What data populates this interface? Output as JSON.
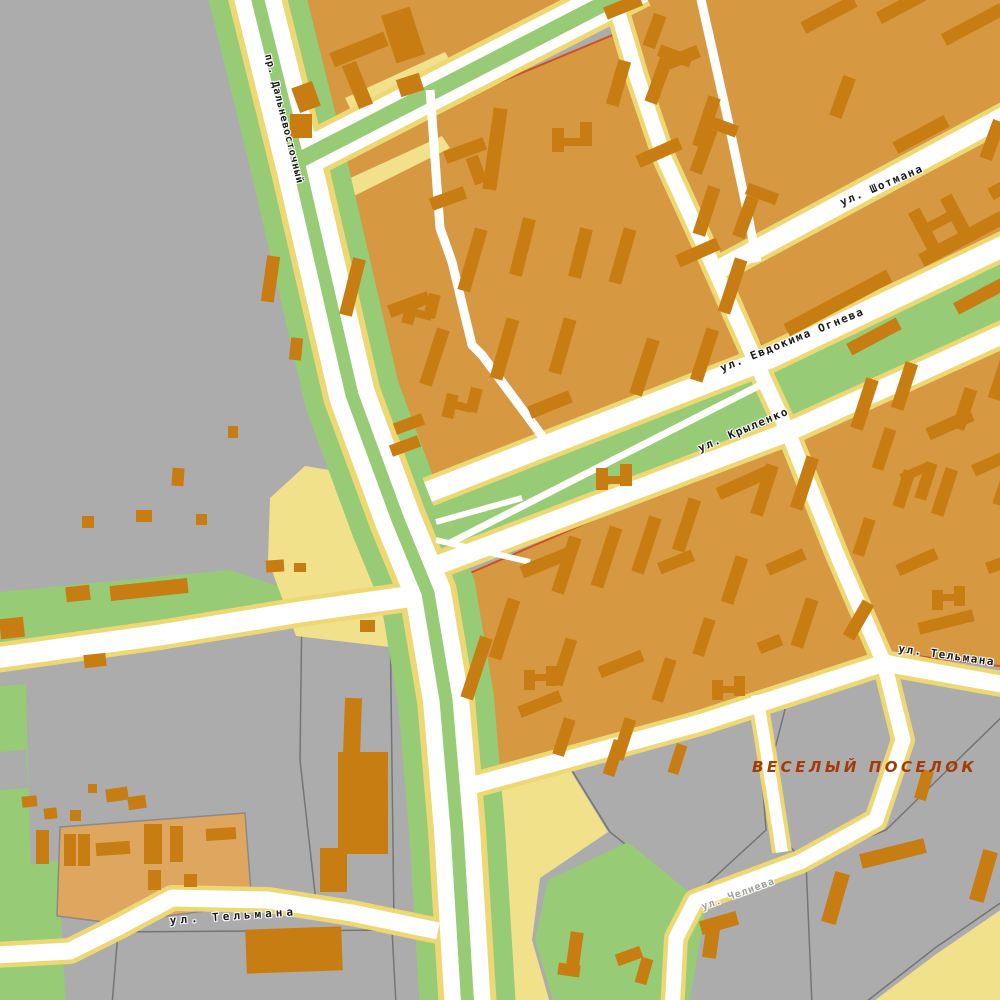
{
  "map": {
    "labels": {
      "prospekt_dalnevostochny": "пр. Дальневосточный",
      "shotmana": "ул. Шотмана",
      "evdokima_ogneva": "ул. Евдокима Огнева",
      "krylenko": "ул. Крыленко",
      "telmana_east": "ул. Тельмана",
      "telmana_west": "ул. Тельмана",
      "chelieva": "ул. Челиева",
      "district": "ВЕСЕЛЫЙ ПОСЕЛОК"
    },
    "palette": {
      "background_gray": "#ACACAC",
      "residential_orange": "#D69840",
      "residential_light_orange": "#DEA65E",
      "building_brown": "#C77D12",
      "greenery_green": "#97CB76",
      "sand_yellow": "#F1E18B",
      "road_casing_yellow": "#EED874",
      "road_fill_white": "#FFFFFF",
      "block_outline_red": "#D0521C",
      "lot_outline_gray": "#757575",
      "district_label_color": "#A33A08",
      "street_label_color": "#1A1A1A",
      "minor_label_gray": "#9D9D9D"
    },
    "buildings": [
      [
        295,
        84,
        22,
        26,
        -20
      ],
      [
        290,
        114,
        22,
        24,
        0
      ],
      [
        330,
        42,
        58,
        15,
        -22
      ],
      [
        350,
        62,
        15,
        46,
        -22
      ],
      [
        388,
        10,
        30,
        50,
        -18
      ],
      [
        398,
        76,
        24,
        18,
        -18
      ],
      [
        604,
        0,
        38,
        13,
        -22
      ],
      [
        648,
        14,
        13,
        34,
        20
      ],
      [
        652,
        58,
        13,
        46,
        20
      ],
      [
        658,
        50,
        34,
        12,
        20
      ],
      [
        697,
        128,
        13,
        46,
        20
      ],
      [
        704,
        120,
        34,
        12,
        20
      ],
      [
        739,
        196,
        13,
        42,
        20
      ],
      [
        746,
        188,
        32,
        12,
        20
      ],
      [
        800,
        8,
        58,
        13,
        -28
      ],
      [
        876,
        0,
        50,
        13,
        -28
      ],
      [
        940,
        18,
        66,
        13,
        -28
      ],
      [
        836,
        76,
        13,
        42,
        20
      ],
      [
        892,
        128,
        58,
        13,
        -28
      ],
      [
        918,
        208,
        13,
        46,
        -28
      ],
      [
        950,
        194,
        13,
        46,
        -28
      ],
      [
        928,
        216,
        26,
        10,
        -28
      ],
      [
        986,
        120,
        13,
        40,
        20
      ],
      [
        780,
        296,
        116,
        14,
        -28
      ],
      [
        916,
        232,
        92,
        14,
        -28
      ],
      [
        952,
        286,
        70,
        13,
        -28
      ],
      [
        846,
        330,
        56,
        13,
        -28
      ],
      [
        988,
        178,
        42,
        13,
        -28
      ],
      [
        444,
        144,
        42,
        13,
        -20
      ],
      [
        430,
        192,
        36,
        13,
        -20
      ],
      [
        470,
        156,
        13,
        28,
        -20
      ],
      [
        488,
        108,
        14,
        82,
        8
      ],
      [
        552,
        128,
        12,
        24,
        0
      ],
      [
        580,
        122,
        12,
        24,
        0
      ],
      [
        556,
        138,
        28,
        8,
        0
      ],
      [
        612,
        60,
        13,
        46,
        16
      ],
      [
        660,
        52,
        40,
        13,
        -22
      ],
      [
        700,
        96,
        13,
        52,
        18
      ],
      [
        636,
        146,
        46,
        13,
        -24
      ],
      [
        700,
        186,
        13,
        50,
        18
      ],
      [
        726,
        258,
        13,
        56,
        18
      ],
      [
        676,
        246,
        44,
        13,
        -24
      ],
      [
        616,
        228,
        13,
        56,
        16
      ],
      [
        574,
        228,
        13,
        50,
        14
      ],
      [
        516,
        218,
        13,
        58,
        14
      ],
      [
        466,
        228,
        13,
        64,
        16
      ],
      [
        346,
        258,
        13,
        58,
        14
      ],
      [
        388,
        298,
        42,
        13,
        -20
      ],
      [
        428,
        328,
        13,
        58,
        18
      ],
      [
        498,
        318,
        13,
        62,
        16
      ],
      [
        556,
        318,
        13,
        56,
        16
      ],
      [
        596,
        468,
        12,
        22,
        0
      ],
      [
        620,
        464,
        12,
        22,
        0
      ],
      [
        600,
        476,
        22,
        8,
        0
      ],
      [
        638,
        338,
        13,
        58,
        18
      ],
      [
        698,
        328,
        13,
        54,
        18
      ],
      [
        528,
        398,
        44,
        13,
        -22
      ],
      [
        394,
        418,
        30,
        12,
        -20
      ],
      [
        390,
        440,
        30,
        12,
        -20
      ],
      [
        404,
        300,
        12,
        24,
        14
      ],
      [
        426,
        294,
        12,
        24,
        14
      ],
      [
        408,
        310,
        24,
        8,
        14
      ],
      [
        444,
        394,
        12,
        24,
        14
      ],
      [
        468,
        388,
        12,
        24,
        14
      ],
      [
        448,
        402,
        24,
        8,
        14
      ],
      [
        470,
        636,
        13,
        64,
        18
      ],
      [
        498,
        598,
        13,
        62,
        18
      ],
      [
        520,
        556,
        52,
        13,
        -22
      ],
      [
        560,
        536,
        13,
        58,
        18
      ],
      [
        600,
        526,
        13,
        62,
        18
      ],
      [
        640,
        516,
        13,
        58,
        18
      ],
      [
        658,
        556,
        36,
        12,
        -22
      ],
      [
        680,
        498,
        13,
        54,
        18
      ],
      [
        716,
        476,
        56,
        13,
        -24
      ],
      [
        758,
        464,
        13,
        52,
        18
      ],
      [
        798,
        456,
        13,
        54,
        18
      ],
      [
        728,
        556,
        13,
        48,
        18
      ],
      [
        766,
        556,
        40,
        12,
        -24
      ],
      [
        798,
        598,
        13,
        50,
        18
      ],
      [
        698,
        618,
        12,
        38,
        18
      ],
      [
        558,
        638,
        12,
        48,
        18
      ],
      [
        598,
        658,
        46,
        12,
        -22
      ],
      [
        658,
        658,
        12,
        44,
        18
      ],
      [
        518,
        698,
        44,
        12,
        -22
      ],
      [
        558,
        718,
        12,
        38,
        18
      ],
      [
        618,
        718,
        12,
        42,
        18
      ],
      [
        758,
        638,
        24,
        12,
        -22
      ],
      [
        712,
        680,
        11,
        20,
        0
      ],
      [
        734,
        676,
        11,
        20,
        0
      ],
      [
        716,
        686,
        20,
        7,
        0
      ],
      [
        524,
        670,
        11,
        20,
        0
      ],
      [
        546,
        666,
        11,
        20,
        0
      ],
      [
        528,
        674,
        20,
        7,
        0
      ],
      [
        608,
        740,
        12,
        36,
        18
      ],
      [
        672,
        744,
        11,
        30,
        18
      ],
      [
        858,
        378,
        13,
        52,
        18
      ],
      [
        898,
        362,
        13,
        48,
        18
      ],
      [
        878,
        428,
        12,
        42,
        18
      ],
      [
        926,
        418,
        48,
        13,
        -24
      ],
      [
        958,
        388,
        13,
        42,
        18
      ],
      [
        994,
        358,
        13,
        42,
        18
      ],
      [
        938,
        468,
        13,
        48,
        18
      ],
      [
        972,
        458,
        34,
        12,
        -24
      ],
      [
        998,
        468,
        12,
        38,
        18
      ],
      [
        898,
        470,
        12,
        38,
        18
      ],
      [
        920,
        462,
        12,
        38,
        18
      ],
      [
        900,
        468,
        28,
        9,
        -24
      ],
      [
        932,
        590,
        11,
        20,
        0
      ],
      [
        954,
        586,
        11,
        20,
        0
      ],
      [
        936,
        594,
        20,
        7,
        0
      ],
      [
        858,
        518,
        12,
        38,
        18
      ],
      [
        896,
        556,
        42,
        12,
        -24
      ],
      [
        986,
        556,
        38,
        12,
        -20
      ],
      [
        918,
        616,
        56,
        12,
        -14
      ],
      [
        852,
        600,
        13,
        40,
        30
      ],
      [
        264,
        256,
        13,
        46,
        8
      ],
      [
        290,
        338,
        12,
        22,
        6
      ],
      [
        228,
        426,
        10,
        12,
        0
      ],
      [
        172,
        468,
        12,
        18,
        4
      ],
      [
        136,
        510,
        16,
        12,
        0
      ],
      [
        196,
        514,
        11,
        11,
        0
      ],
      [
        82,
        516,
        12,
        12,
        0
      ],
      [
        66,
        586,
        24,
        15,
        -6
      ],
      [
        110,
        582,
        78,
        15,
        -6
      ],
      [
        0,
        618,
        24,
        20,
        -6
      ],
      [
        84,
        654,
        22,
        13,
        -6
      ],
      [
        266,
        560,
        18,
        12,
        -4
      ],
      [
        294,
        563,
        12,
        9,
        0
      ],
      [
        22,
        796,
        15,
        11,
        -6
      ],
      [
        44,
        808,
        13,
        11,
        -6
      ],
      [
        70,
        810,
        11,
        11,
        0
      ],
      [
        106,
        788,
        22,
        13,
        -8
      ],
      [
        128,
        796,
        18,
        13,
        -8
      ],
      [
        88,
        784,
        9,
        9,
        0
      ],
      [
        184,
        874,
        13,
        13,
        0
      ],
      [
        36,
        830,
        13,
        34,
        0
      ],
      [
        64,
        834,
        12,
        32,
        0
      ],
      [
        78,
        834,
        12,
        32,
        0
      ],
      [
        96,
        842,
        34,
        13,
        -4
      ],
      [
        144,
        824,
        18,
        40,
        0
      ],
      [
        170,
        826,
        13,
        36,
        0
      ],
      [
        148,
        870,
        13,
        20,
        0
      ],
      [
        206,
        828,
        30,
        12,
        -4
      ],
      [
        360,
        620,
        15,
        12,
        0
      ],
      [
        344,
        698,
        17,
        58,
        2
      ],
      [
        338,
        752,
        50,
        102,
        0
      ],
      [
        320,
        848,
        27,
        44,
        0
      ],
      [
        246,
        928,
        96,
        44,
        -2
      ],
      [
        568,
        932,
        13,
        40,
        8
      ],
      [
        558,
        964,
        22,
        12,
        8
      ],
      [
        616,
        950,
        26,
        12,
        -20
      ],
      [
        638,
        958,
        12,
        26,
        16
      ],
      [
        918,
        770,
        12,
        30,
        16
      ],
      [
        828,
        872,
        15,
        52,
        16
      ],
      [
        860,
        846,
        66,
        15,
        -14
      ],
      [
        976,
        850,
        15,
        52,
        16
      ],
      [
        700,
        916,
        38,
        14,
        -16
      ],
      [
        704,
        928,
        14,
        30,
        8
      ]
    ]
  }
}
